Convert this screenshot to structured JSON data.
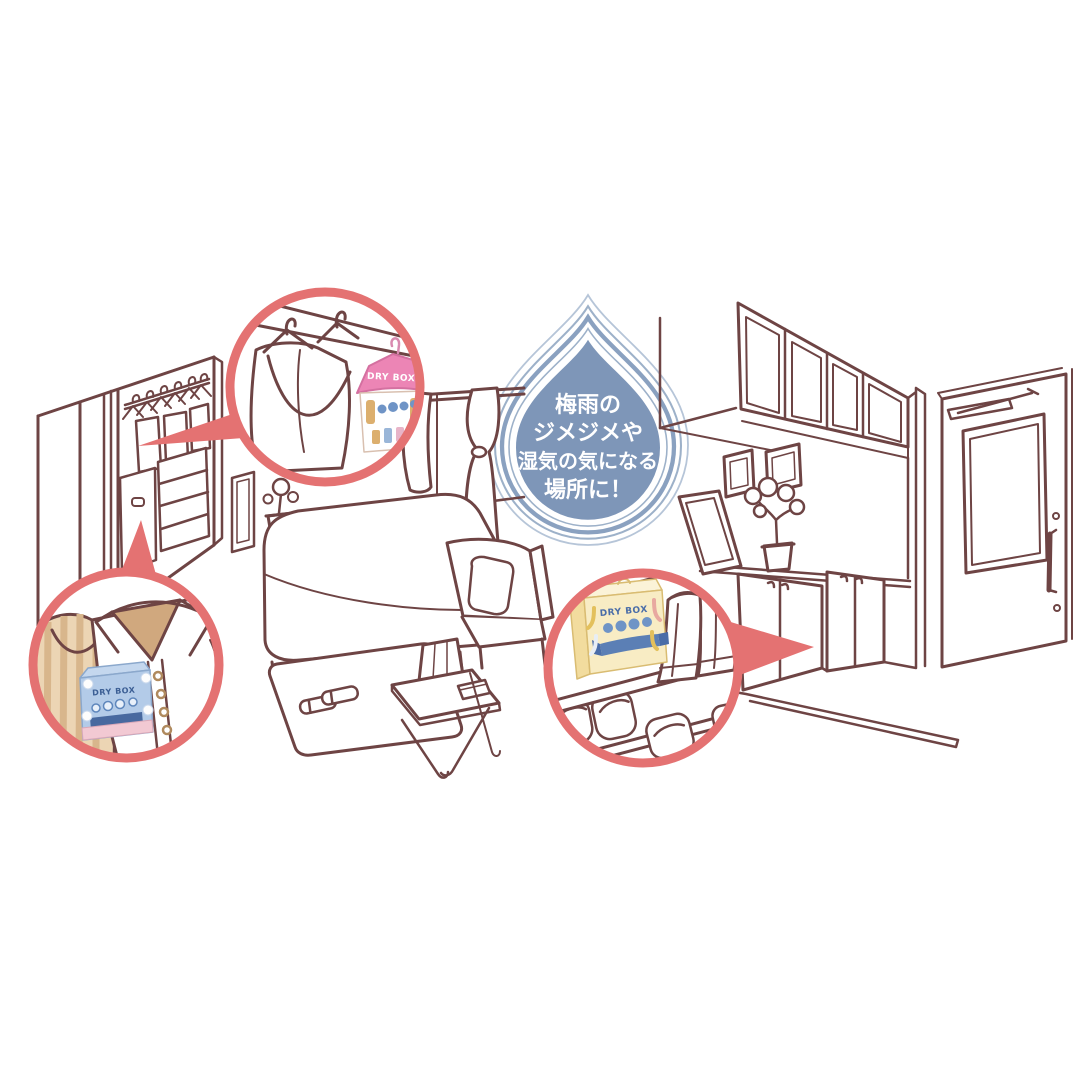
{
  "illustration": {
    "background": "#ffffff",
    "line_color": "#6e4444",
    "callout_color": "#e47272"
  },
  "droplet_badge": {
    "fill": "#7e96b8",
    "ring_color": "#8aa1c0",
    "text_color": "#ffffff",
    "lines": [
      "梅雨の",
      "ジメジメや",
      "湿気の気になる",
      "場所に！"
    ]
  },
  "products": {
    "closet_hanging": {
      "label": "DRY BOX",
      "accent_color": "#ec85b5"
    },
    "drawer_pack": {
      "label": "DRY BOX",
      "accent_color": "#b3cbe8"
    },
    "shoe_box": {
      "label": "DRY BOX",
      "accent_color": "#f8ecc4"
    }
  },
  "icons": {
    "droplet": "water-droplet",
    "hanger": "clothes-hanger"
  }
}
